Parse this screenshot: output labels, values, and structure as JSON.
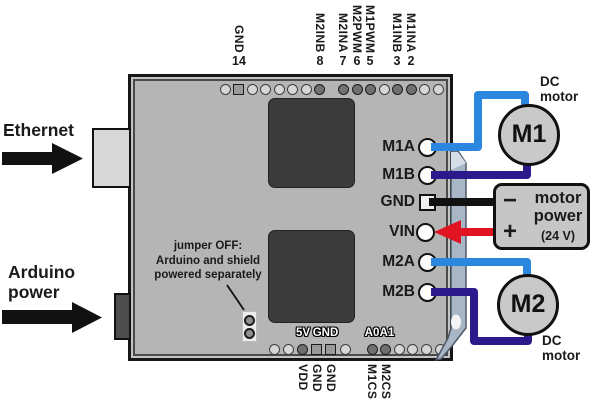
{
  "colors": {
    "board": "#b5b5b5",
    "ic": "#3b3b3b",
    "motor": "#c9c9c9",
    "power_box": "#c6c6c6",
    "terminal_strip": "#a9b6c6",
    "wire_m_a": "#2b86dd",
    "wire_m_b": "#2c1a8c",
    "wire_gnd": "#111111",
    "wire_vin": "#e11422",
    "arrow_black": "#111111"
  },
  "left_labels": {
    "ethernet": "Ethernet",
    "arduino_line1": "Arduino",
    "arduino_line2": "power"
  },
  "top_header": {
    "labels": [
      {
        "name": "GND",
        "number": "14"
      },
      {
        "name": "M2INB",
        "number": "8"
      },
      {
        "name": "M2INA",
        "number": "7"
      },
      {
        "name": "M2PWM",
        "number": "6"
      },
      {
        "name": "M1PWM",
        "number": "5"
      },
      {
        "name": "M1INB",
        "number": "3"
      },
      {
        "name": "M1INA",
        "number": "2"
      }
    ]
  },
  "bottom_header": {
    "labels": [
      "VDD",
      "GND",
      "GND",
      "M1CS",
      "M2CS"
    ]
  },
  "board_silkscreen": {
    "labels": [
      "5V",
      "GND",
      "A0",
      "A1"
    ]
  },
  "right_header": {
    "pins": [
      "M1A",
      "M1B",
      "GND",
      "VIN",
      "M2A",
      "M2B"
    ]
  },
  "motors": {
    "m1_label": "M1",
    "m2_label": "M2",
    "m1_caption_line1": "DC",
    "m1_caption_line2": "motor",
    "m2_caption_line1": "DC",
    "m2_caption_line2": "motor"
  },
  "power_box": {
    "minus_symbol": "−",
    "plus_symbol": "+",
    "title_line1": "motor",
    "title_line2": "power",
    "voltage": "(24 V)"
  },
  "jumper_note": {
    "line1": "jumper OFF:",
    "line2": "Arduino and shield",
    "line3": "powered separately"
  },
  "pin_rows": {
    "top_left": [
      "L",
      "S",
      "L",
      "L",
      "L",
      "L",
      "L",
      "D"
    ],
    "top_right": [
      "D",
      "D",
      "D",
      "L",
      "D",
      "D",
      "L",
      "L"
    ],
    "bottom_left": [
      "L",
      "L",
      "D",
      "S",
      "S",
      "L"
    ],
    "bottom_right": [
      "D",
      "D",
      "L",
      "L",
      "L",
      "L"
    ]
  }
}
